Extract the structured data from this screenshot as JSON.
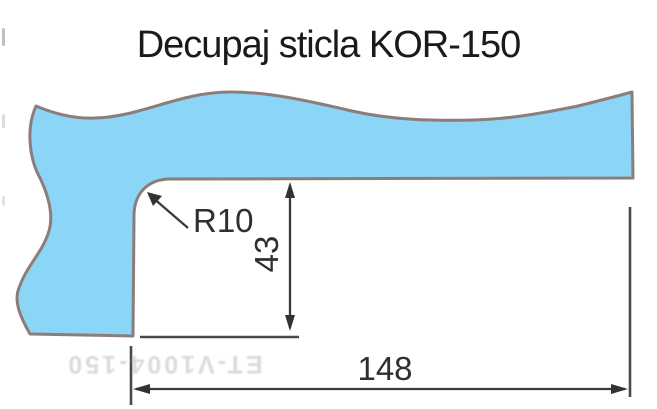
{
  "title": "Decupaj sticla KOR-150",
  "labels": {
    "radius": "R10",
    "height": "43",
    "width": "148"
  },
  "watermark": "ET-V1004-150",
  "colors": {
    "glass_fill": "#8BD5F7",
    "glass_outline": "#8D7D7A",
    "dimension": "#333333",
    "title_text": "#1A1A1A",
    "background": "#FFFFFF"
  }
}
